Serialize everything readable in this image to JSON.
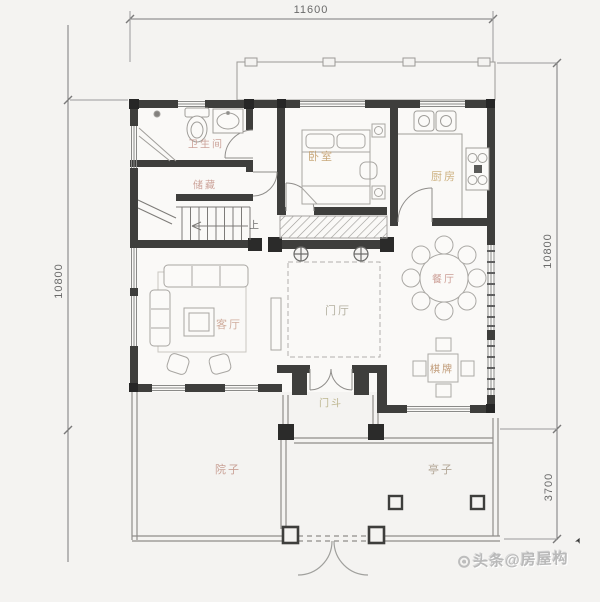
{
  "dimensions": {
    "top": "11600",
    "left": "10800",
    "right_upper": "10800",
    "right_lower": "3700"
  },
  "rooms": {
    "bathroom": {
      "label": "卫生间"
    },
    "storage": {
      "label": "储藏"
    },
    "bedroom": {
      "label": "卧室"
    },
    "kitchen": {
      "label": "厨房"
    },
    "living_room": {
      "label": "客厅"
    },
    "foyer": {
      "label": "门厅"
    },
    "dining_room": {
      "label": "餐厅"
    },
    "game_room": {
      "label": "棋牌"
    },
    "vestibule": {
      "label": "门斗"
    },
    "courtyard": {
      "label": "院子"
    },
    "pavilion": {
      "label": "亭子"
    }
  },
  "stairs": {
    "direction_label": "上"
  },
  "watermark": {
    "text": "头条@房屋构"
  },
  "colors": {
    "wall": "#3e3e3c",
    "thin_line": "#8f8d8a",
    "furniture_line": "#adaba7",
    "dimension_text": "#6a6a6a",
    "label_terracotta": "#c4958a",
    "label_tan": "#c09a66",
    "label_olive": "#b3ab7d",
    "watermark_gray": "#b9b9b9",
    "background": "#f4f3f1"
  }
}
